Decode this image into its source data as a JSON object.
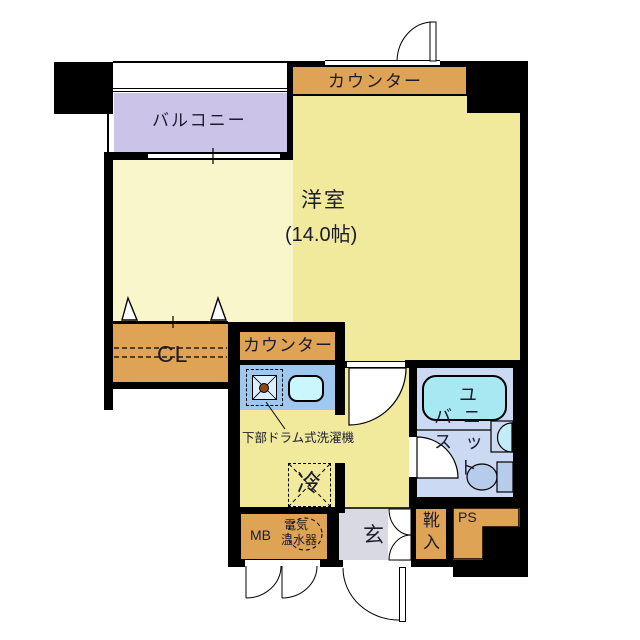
{
  "floorplan": {
    "rooms": {
      "balcony": "バルコニー",
      "counter_top": "カウンター",
      "main_room": "洋室",
      "main_room_size": "(14.0帖)",
      "closet": "CL",
      "kitchen_counter": "カウンター",
      "entrance": "玄",
      "pipe_space": "PS",
      "meter_box": "MB"
    },
    "fixtures": {
      "washer_note": "下部ドラム式洗濯機",
      "fridge": "冷",
      "water_heater_1": "電気",
      "water_heater_2": "温水器",
      "shoe_1": "靴",
      "shoe_2": "入",
      "bath_1": "ユ",
      "bath_2": "ニ",
      "bath_3": "ッ",
      "bath_4": "ト",
      "bath_5": "バ",
      "bath_6": "ス"
    },
    "colors": {
      "wall": "#000000",
      "room_yellow": "#f1e99b",
      "room_pale": "#faf6cc",
      "balcony_purple": "#cbc3e8",
      "counter_orange": "#dfa355",
      "kitchen_blue": "#9fc8ee",
      "bath_blue": "#ccd9f2",
      "bathtub_cyan": "#a8e8f2",
      "sink_cyan": "#c9f7fb",
      "entrance_gray": "#d9d9e1",
      "toilet_blue": "#b7cbea"
    }
  }
}
